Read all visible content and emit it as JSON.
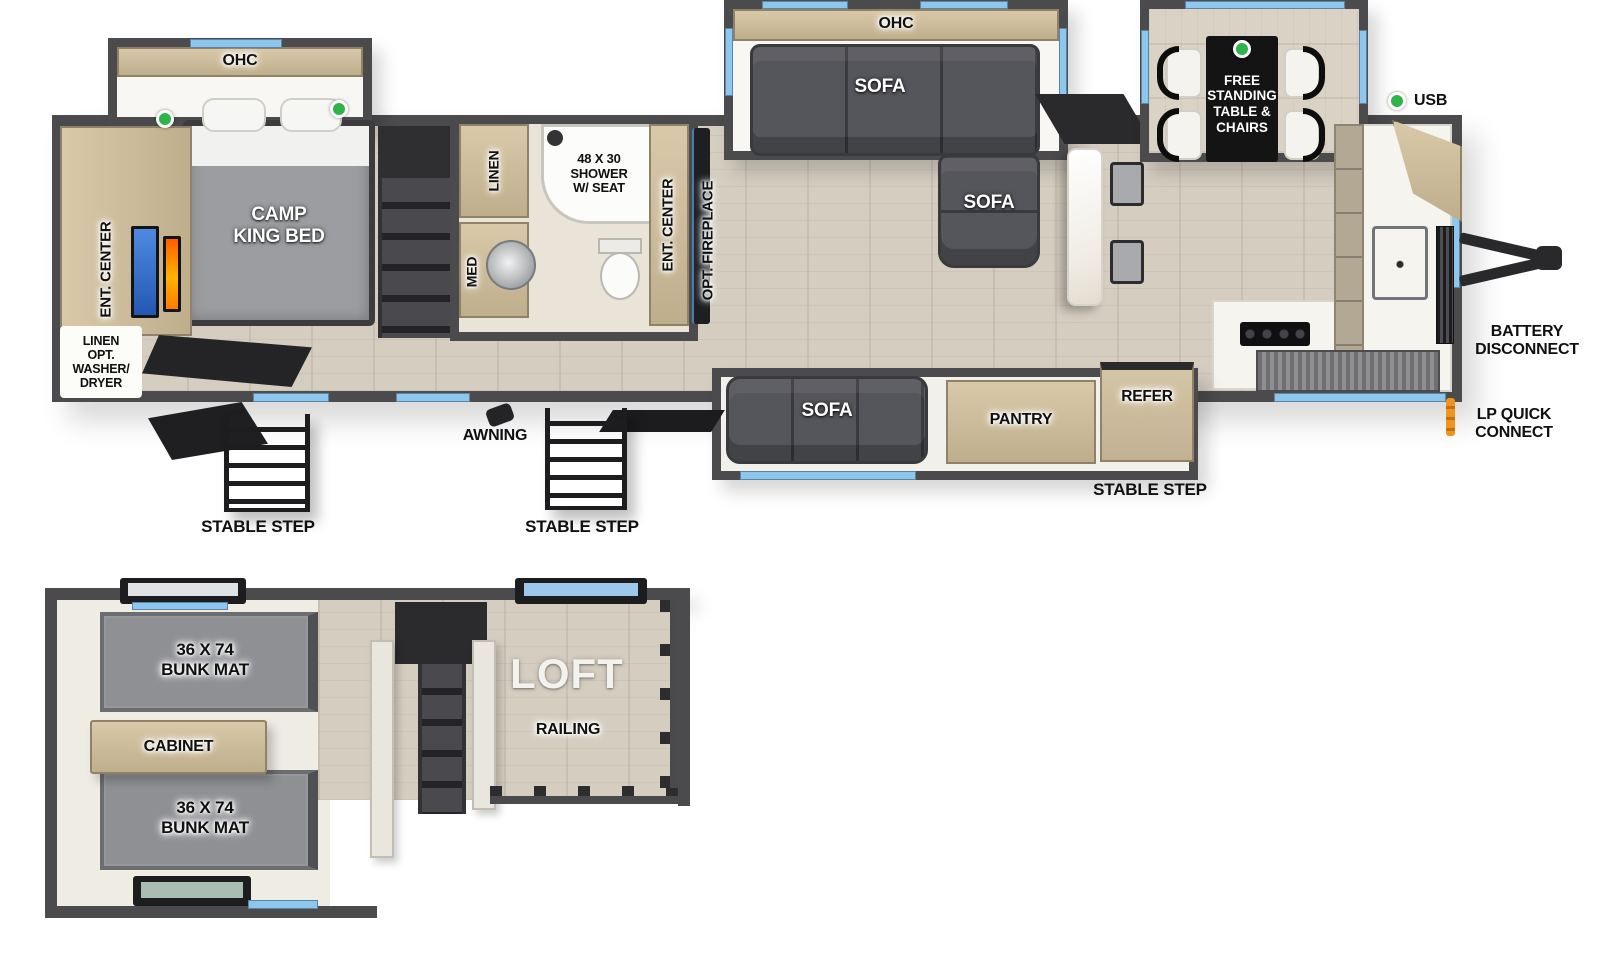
{
  "palette": {
    "wall": "#4b4b4e",
    "window_blue": "#8ec7ee",
    "accent_green": "#2db44a",
    "lp_orange": "#f0941e"
  },
  "main_plan": {
    "bedroom_ohc": "OHC",
    "camp_king_bed": "CAMP\nKING BED",
    "bedroom_ent_center": "ENT. CENTER",
    "linen_opt_washer_dryer": "LINEN\nOPT.\nWASHER/\nDRYER",
    "linen": "LINEN",
    "shower": "48 X 30\nSHOWER\nW/ SEAT",
    "med": "MED",
    "bath_ent_center": "ENT. CENTER",
    "opt_fireplace": "OPT. FIREPLACE",
    "living_ohc": "OHC",
    "sofa_slide": "SOFA",
    "sofa_chaise": "SOFA",
    "sofa_door_side": "SOFA",
    "free_standing_table": "FREE\nSTANDING\nTABLE &\nCHAIRS",
    "pantry": "PANTRY",
    "refer": "REFER",
    "usb": "USB",
    "battery_disconnect": "BATTERY\nDISCONNECT",
    "lp_quick_connect": "LP QUICK\nCONNECT",
    "awning": "AWNING",
    "stable_step_rear": "STABLE STEP",
    "stable_step_center": "STABLE STEP",
    "stable_step_door": "STABLE STEP"
  },
  "loft_plan": {
    "bunk_mat_top": "36 X 74\nBUNK MAT",
    "bunk_mat_bottom": "36 X 74\nBUNK MAT",
    "cabinet": "CABINET",
    "loft": "LOFT",
    "railing": "RAILING"
  }
}
